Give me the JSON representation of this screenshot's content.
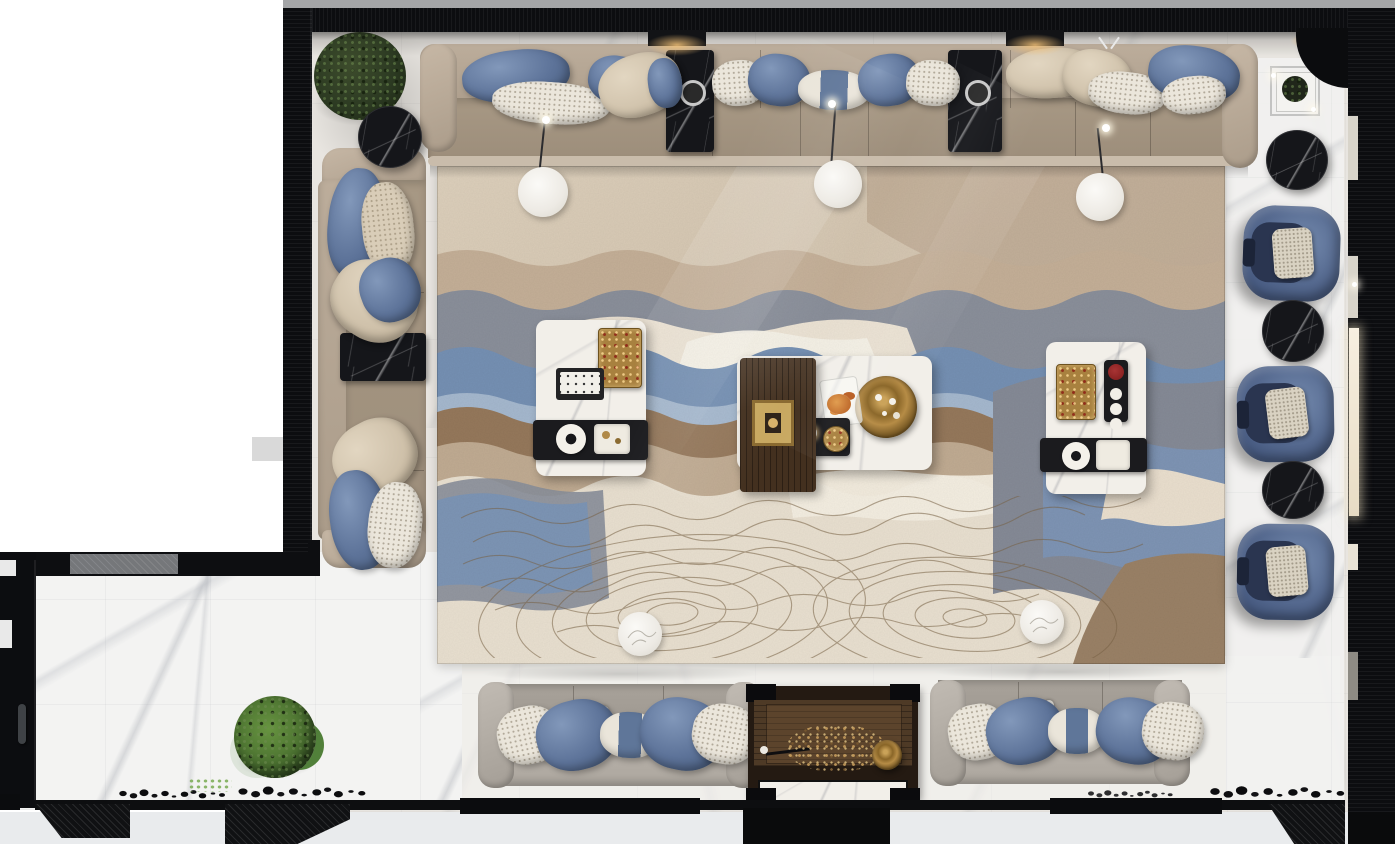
{
  "meta": {
    "title": "Top-down architectural render of a luxury blue-and-beige lounge",
    "type": "3d-render-plan-view",
    "canvas": {
      "width": 1395,
      "height": 844
    }
  },
  "palette": {
    "wall": "#0c0d10",
    "topStrip": "#a4a5a7",
    "marble": "#e8e5e0",
    "marbleBright": "#f3f3f2",
    "outsideGray": "#e9ebed",
    "rugBase": "#d3c4ae",
    "rugBlue": "#7590b3",
    "rugLightBlue": "#a9bcd0",
    "rugSlate": "#8a8f9a",
    "rugBrown": "#95785b",
    "rugTan": "#c0ab92",
    "rugCream": "#e9e0d0",
    "contourLine": "#7a6346",
    "sofaBeige": "#b6a795",
    "sofaSeat": "#a49682",
    "sofaGray": "#aaa49c",
    "pillowBlue": "#5d7399",
    "pillowWhite": "#ebe6db",
    "pillowBeige": "#d3c6b1",
    "chairBlue": "#54688e",
    "cushionBeige": "#d9d2c2",
    "blackMarble": "#15161a",
    "whiteMarbleTable": "#f2efe9",
    "brass": "#a8813f",
    "wood": "#43301f",
    "woodDark": "#241a12",
    "plantDark": "#2c3a22",
    "plantGreen": "#4a7030",
    "glowWarm": "#f5c378",
    "lightBar": "#f7efe0"
  },
  "scene": {
    "architecture": {
      "walls": {
        "label": "Dark slatted walls framing the room"
      },
      "floor_main": {
        "label": "Beige marble floor of the lounge"
      },
      "floor_walkway": {
        "label": "White marble walkway, bottom-left wing"
      },
      "door": {
        "label": "Dark door with handle on the lower-left wall"
      },
      "bottom_wall": {
        "label": "Bottom wall with angled black partitions"
      }
    },
    "rug": {
      "label": "Large abstract landscape rug: blue, slate, brown and cream waves with topographic contour lines",
      "colors": [
        "#d3c4ae",
        "#7590b3",
        "#8a8f9a",
        "#95785b",
        "#e9e0d0"
      ]
    },
    "seating": {
      "sofa_top": {
        "label": "Long beige modular sofa along the top wall",
        "pillows": [
          "blue velvet",
          "white patterned",
          "beige"
        ]
      },
      "sofa_left": {
        "label": "Beige modular sofa along the left wall with black marble inset table"
      },
      "sofa_bottom_left": {
        "label": "Grey three-seat sofa, bottom left, facing the rug"
      },
      "sofa_bottom_right": {
        "label": "Grey three-seat sofa, bottom right, facing the rug"
      },
      "armchairs": {
        "label": "Blue velvet barrel armchairs along the right wall",
        "count": 3
      }
    },
    "tables": {
      "coffee_left": {
        "label": "White marble coffee table with gold tray, remote tray and black serving tray"
      },
      "coffee_center": {
        "label": "White marble coffee table with walnut panel, brass candle block and round brass tray"
      },
      "coffee_right": {
        "label": "White marble coffee table with gold tray, rose tray and serving tray"
      },
      "side_black_round": {
        "label": "Round black marble side tables",
        "count": 4
      },
      "side_black_inset": {
        "label": "Black marble tables inset into the sofas",
        "count": 3
      },
      "glass_corner": {
        "label": "Glass side table with dark vase, top-right corner"
      },
      "console_bottom": {
        "label": "Dark walnut coffee table with dried flowers, rod and brass bowl"
      }
    },
    "plants": {
      "tree_top_left": {
        "label": "Potted green tree in the top-left corner"
      },
      "bush_bottom_left": {
        "label": "Round green shrub on the walkway"
      },
      "sprig_bottom": {
        "label": "Small green tuft at the bottom edge"
      }
    },
    "lighting": {
      "floor_lamps": {
        "label": "White disc floor reading lamps",
        "count": 3
      },
      "ceiling_glows": {
        "label": "Warm recessed ceiling lights under the top wall",
        "count": 2
      },
      "wall_light_bar": {
        "label": "Vertical warm light strip on the right wall"
      },
      "sparkles": {
        "label": "Specular light glints",
        "count": 3
      }
    },
    "decor": {
      "poufs": {
        "label": "White round poufs on the rug",
        "count": 2
      },
      "pebbles": {
        "label": "Black pebble decoration rows along the bottom floor edge",
        "count": 4
      },
      "small_lamps": {
        "label": "Small chrome reading lamps behind the bottom sofas",
        "count": 2
      }
    }
  }
}
